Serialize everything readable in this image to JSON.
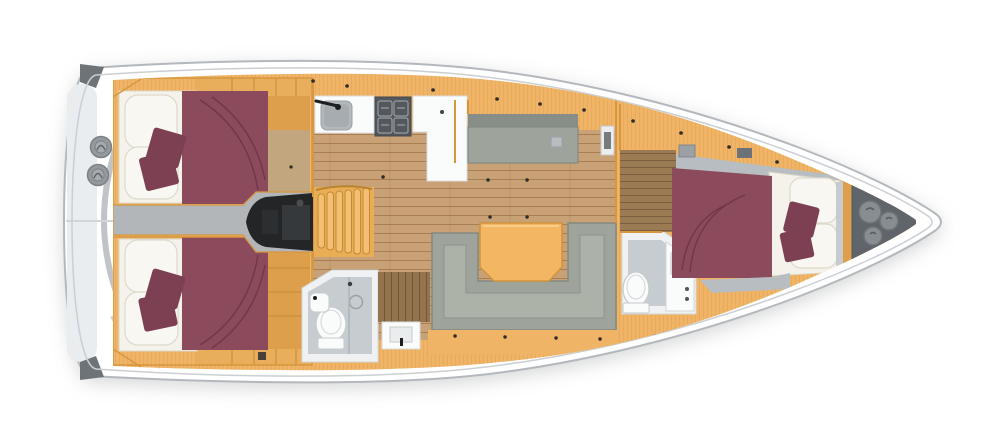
{
  "diagram": {
    "type": "sailing-yacht-interior-floor-plan",
    "view": "top-down",
    "orientation": {
      "bow": "right",
      "stern": "left"
    },
    "rooms": [
      {
        "id": "aft-cabin-port",
        "name": "aft double cabin (top)"
      },
      {
        "id": "aft-cabin-starboard",
        "name": "aft double cabin (bottom)"
      },
      {
        "id": "engine-compartment",
        "name": "engine compartment"
      },
      {
        "id": "companionway",
        "name": "companionway steps"
      },
      {
        "id": "galley",
        "name": "galley with sink and stove"
      },
      {
        "id": "salon",
        "name": "salon with U-sofa, table and settee"
      },
      {
        "id": "aft-head",
        "name": "aft head with shower and toilet"
      },
      {
        "id": "forward-head",
        "name": "forward head with toilet and vanity"
      },
      {
        "id": "forward-cabin",
        "name": "forward double cabin"
      },
      {
        "id": "anchor-locker",
        "name": "bow anchor locker with deck hatches"
      }
    ]
  },
  "palette": {
    "hull_white": "#ffffff",
    "hull_line": "#b4b8bc",
    "deck_inner_line": "#cbcfd3",
    "stern_wash": "#eaedef",
    "stern_arc": "#b9bdc2",
    "corner_cap": "#6e7378",
    "winch": "#94999d",
    "winch_ring": "#7c8185",
    "winch_inner": "#a6abaf",
    "wood_cabinet": "#efb465",
    "wood_cabinet_dark": "#dd9f4c",
    "shelf_tint": "#e9ae5b",
    "wall_line": "#d6973f",
    "wood_floor": "#c9a177",
    "cabin_floor": "#c2a67e",
    "wood_dark": "#9a7b54",
    "wood_shower": "#93744e",
    "stairs": "#e9ad55",
    "stair_slat": "#f3bf70",
    "stair_slat_line": "#c18a38",
    "bed_burgundy": "#8c4a5d",
    "cushion_burgundy": "#7d4053",
    "bedding_white": "#f4f2ea",
    "pillow_white": "#f9f7f1",
    "pillow_edge": "#ddd9cb",
    "sofa_gray": "#9ea49c",
    "sofa_dark": "#848a80",
    "sofa_light": "#acb2a8",
    "settee_back": "#878e88",
    "table_orange": "#f3b763",
    "table_line": "#d1933c",
    "engine_black": "#232527",
    "engine_detail": "#36393c",
    "corridor_gray": "#b2b6b9",
    "bath_white": "#eff1f2",
    "bath_floor": "#c7ccd0",
    "fixture_white": "#fafbfb",
    "fixture_line": "#c6cbce",
    "stove_gray": "#54585c",
    "stove_grate": "#979da1",
    "sink_gray": "#b2b8bc",
    "sink_inner": "#a6acb0",
    "locker_gray": "#60656b",
    "hatch_gray": "#888d91",
    "hatch_ring": "#6e7378",
    "shelf_gray": "#b7bdc0",
    "dot_black": "#2f2d29",
    "faucet_black": "#1d1e1f"
  }
}
